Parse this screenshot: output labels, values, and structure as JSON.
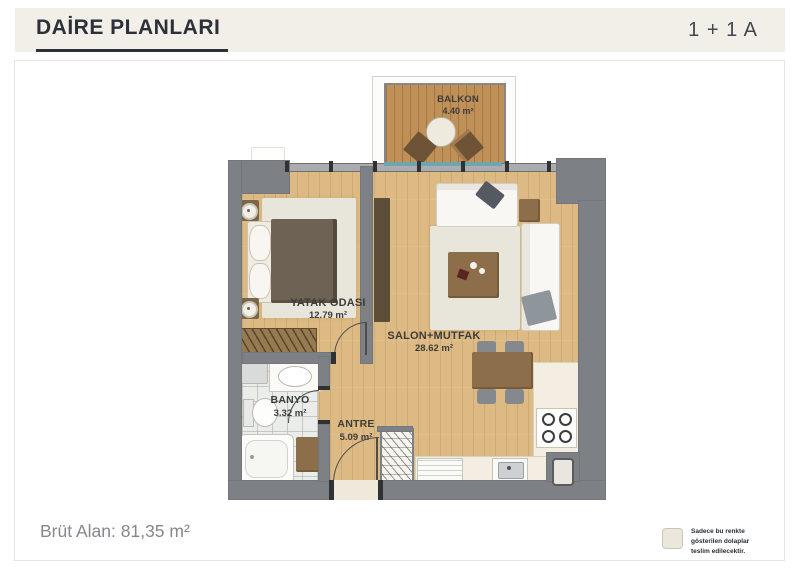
{
  "header": {
    "title": "DAİRE PLANLARI",
    "plan_type": "1 + 1 A"
  },
  "floor_plan": {
    "rooms": [
      {
        "name": "BALKON",
        "area": "4.40 m²"
      },
      {
        "name": "YATAK ODASI",
        "area": "12.79 m²"
      },
      {
        "name": "SALON+MUTFAK",
        "area": "28.62 m²"
      },
      {
        "name": "BANYO",
        "area": "3.32 m²"
      },
      {
        "name": "ANTRE",
        "area": "5.09 m²"
      }
    ]
  },
  "footer": {
    "gross_area": "Brüt Alan: 81,35 m²",
    "note_lines": [
      "Sadece bu renkte",
      "gösterilen dolaplar",
      "teslim edilecektir."
    ]
  },
  "colors": {
    "header-bg": "#f1efe8",
    "title": "#2c3038",
    "wall": "#7d8084",
    "floor": "#ddba84",
    "balcony-floor": "#bf9057",
    "rug": "#e8e5da",
    "cabinet-brown": "#8c6e4a",
    "counter": "#f3eee1",
    "note-swatch": "#ebe7da",
    "footer-text": "#84888c"
  }
}
